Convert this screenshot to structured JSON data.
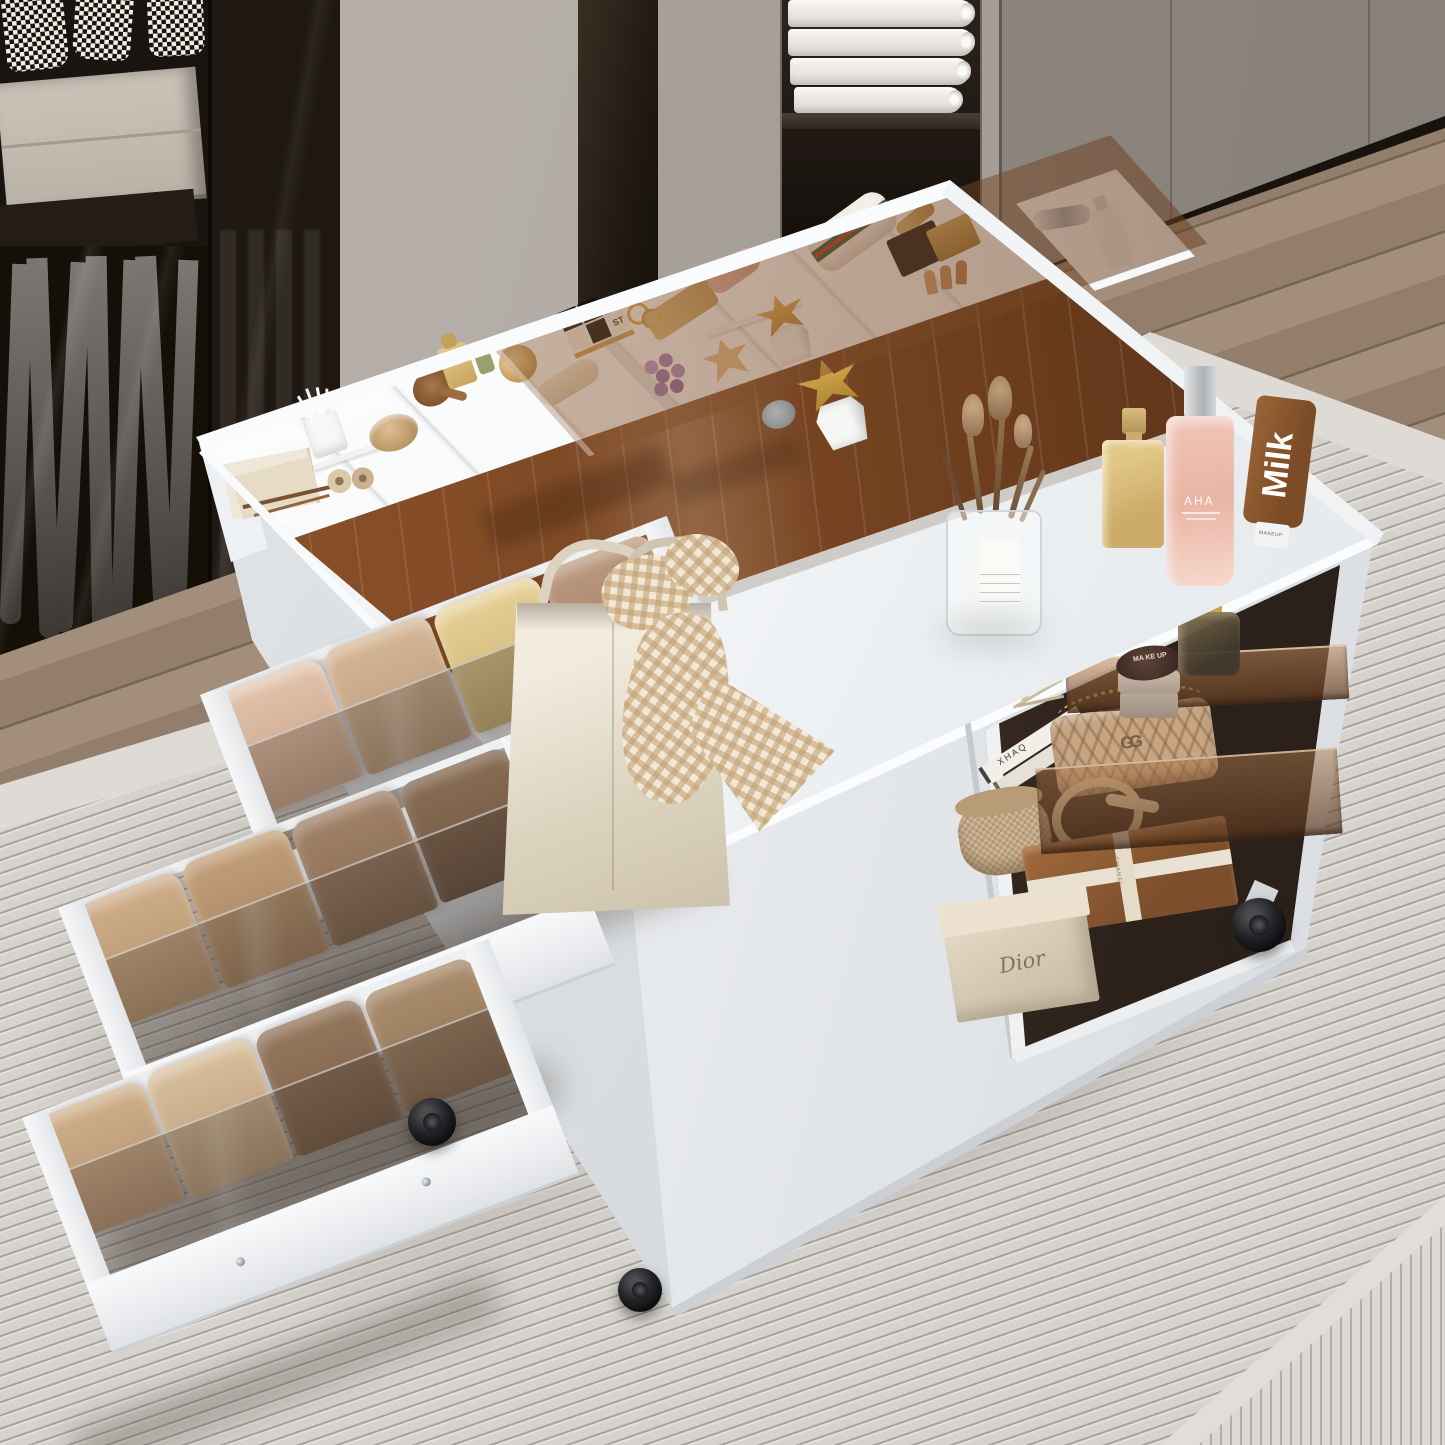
{
  "scene": {
    "type": "product lifestyle photograph",
    "subject": "White mobile makeup vanity storage island with glass-top organizer, pull-out clothes drawers and open side shelf",
    "setting": [
      "dark wardrobe with smoked glass doors and hanging trousers",
      "houndstooth garments on rail",
      "grey cabinet wall",
      "folded white towels in dark niche",
      "oak wood floor",
      "ribbed ivory rug"
    ]
  },
  "palette": {
    "wall": "#b7b0aa",
    "cabinet_grey": "#948d86",
    "wardrobe_dark": "#1a1410",
    "floor_wood": "#9b8671",
    "rug": "#d6d2cd",
    "island_white": "#f2f4f6",
    "smoked_glass_brown": "#7a4a27",
    "shelf_glass": "#a97a4e",
    "clothes_beige": "#c4a583"
  },
  "labels": {
    "aha": "AHA",
    "milk": "Milk",
    "milk_cap": "MAKEUP",
    "makeup_jar": "MA KE UP",
    "dior": "Dior",
    "chanel": "CHANEL",
    "st_cube": "ST",
    "gucci_logo": "GG",
    "magazine_spine": "XHAQ"
  },
  "background": {
    "wardrobe": {
      "hanging_garments": 3,
      "drawer_fronts": 2,
      "trousers": 7
    },
    "towel_niche": {
      "towels": 4
    },
    "cabinet_seams": 5
  },
  "island": {
    "tray_items": [
      "note papers",
      "pencils",
      "cotton swab cup",
      "washi tape rolls",
      "wooden bowl",
      "hair brush",
      "gold perfume",
      "green bottle",
      "gold cream jar",
      "hand cream tube",
      "puzzle cube blocks",
      "rings",
      "lying perfume",
      "pink lotion",
      "bead necklace",
      "star trinket dish",
      "succulent in geometric pot",
      "striped cosmetic pouch",
      "gold lipstick",
      "makeup palettes",
      "silver tool",
      "white pump bottle",
      "small grey jar"
    ],
    "counter_items": [
      "canvas tote bag",
      "gingham scarf",
      "glass cup with makeup brushes",
      "gold perfume bottle",
      "AHA pink mist bottle",
      "Milk makeup tube"
    ],
    "shelf_items": [
      "fashion magazines",
      "fern sprig",
      "stacked makeup jars",
      "quilted chain bag",
      "amber perfume bottle",
      "patterned hat box",
      "belt ribbon",
      "ribbon gift box",
      "designer box",
      "leather box"
    ],
    "drawers": [
      {
        "position": "top",
        "contents": "folded knitwear",
        "stacks": 4
      },
      {
        "position": "middle",
        "contents": "folded knitwear",
        "stacks": 4
      },
      {
        "position": "bottom",
        "contents": "folded knitwear",
        "stacks": 4
      }
    ],
    "casters": 3
  }
}
